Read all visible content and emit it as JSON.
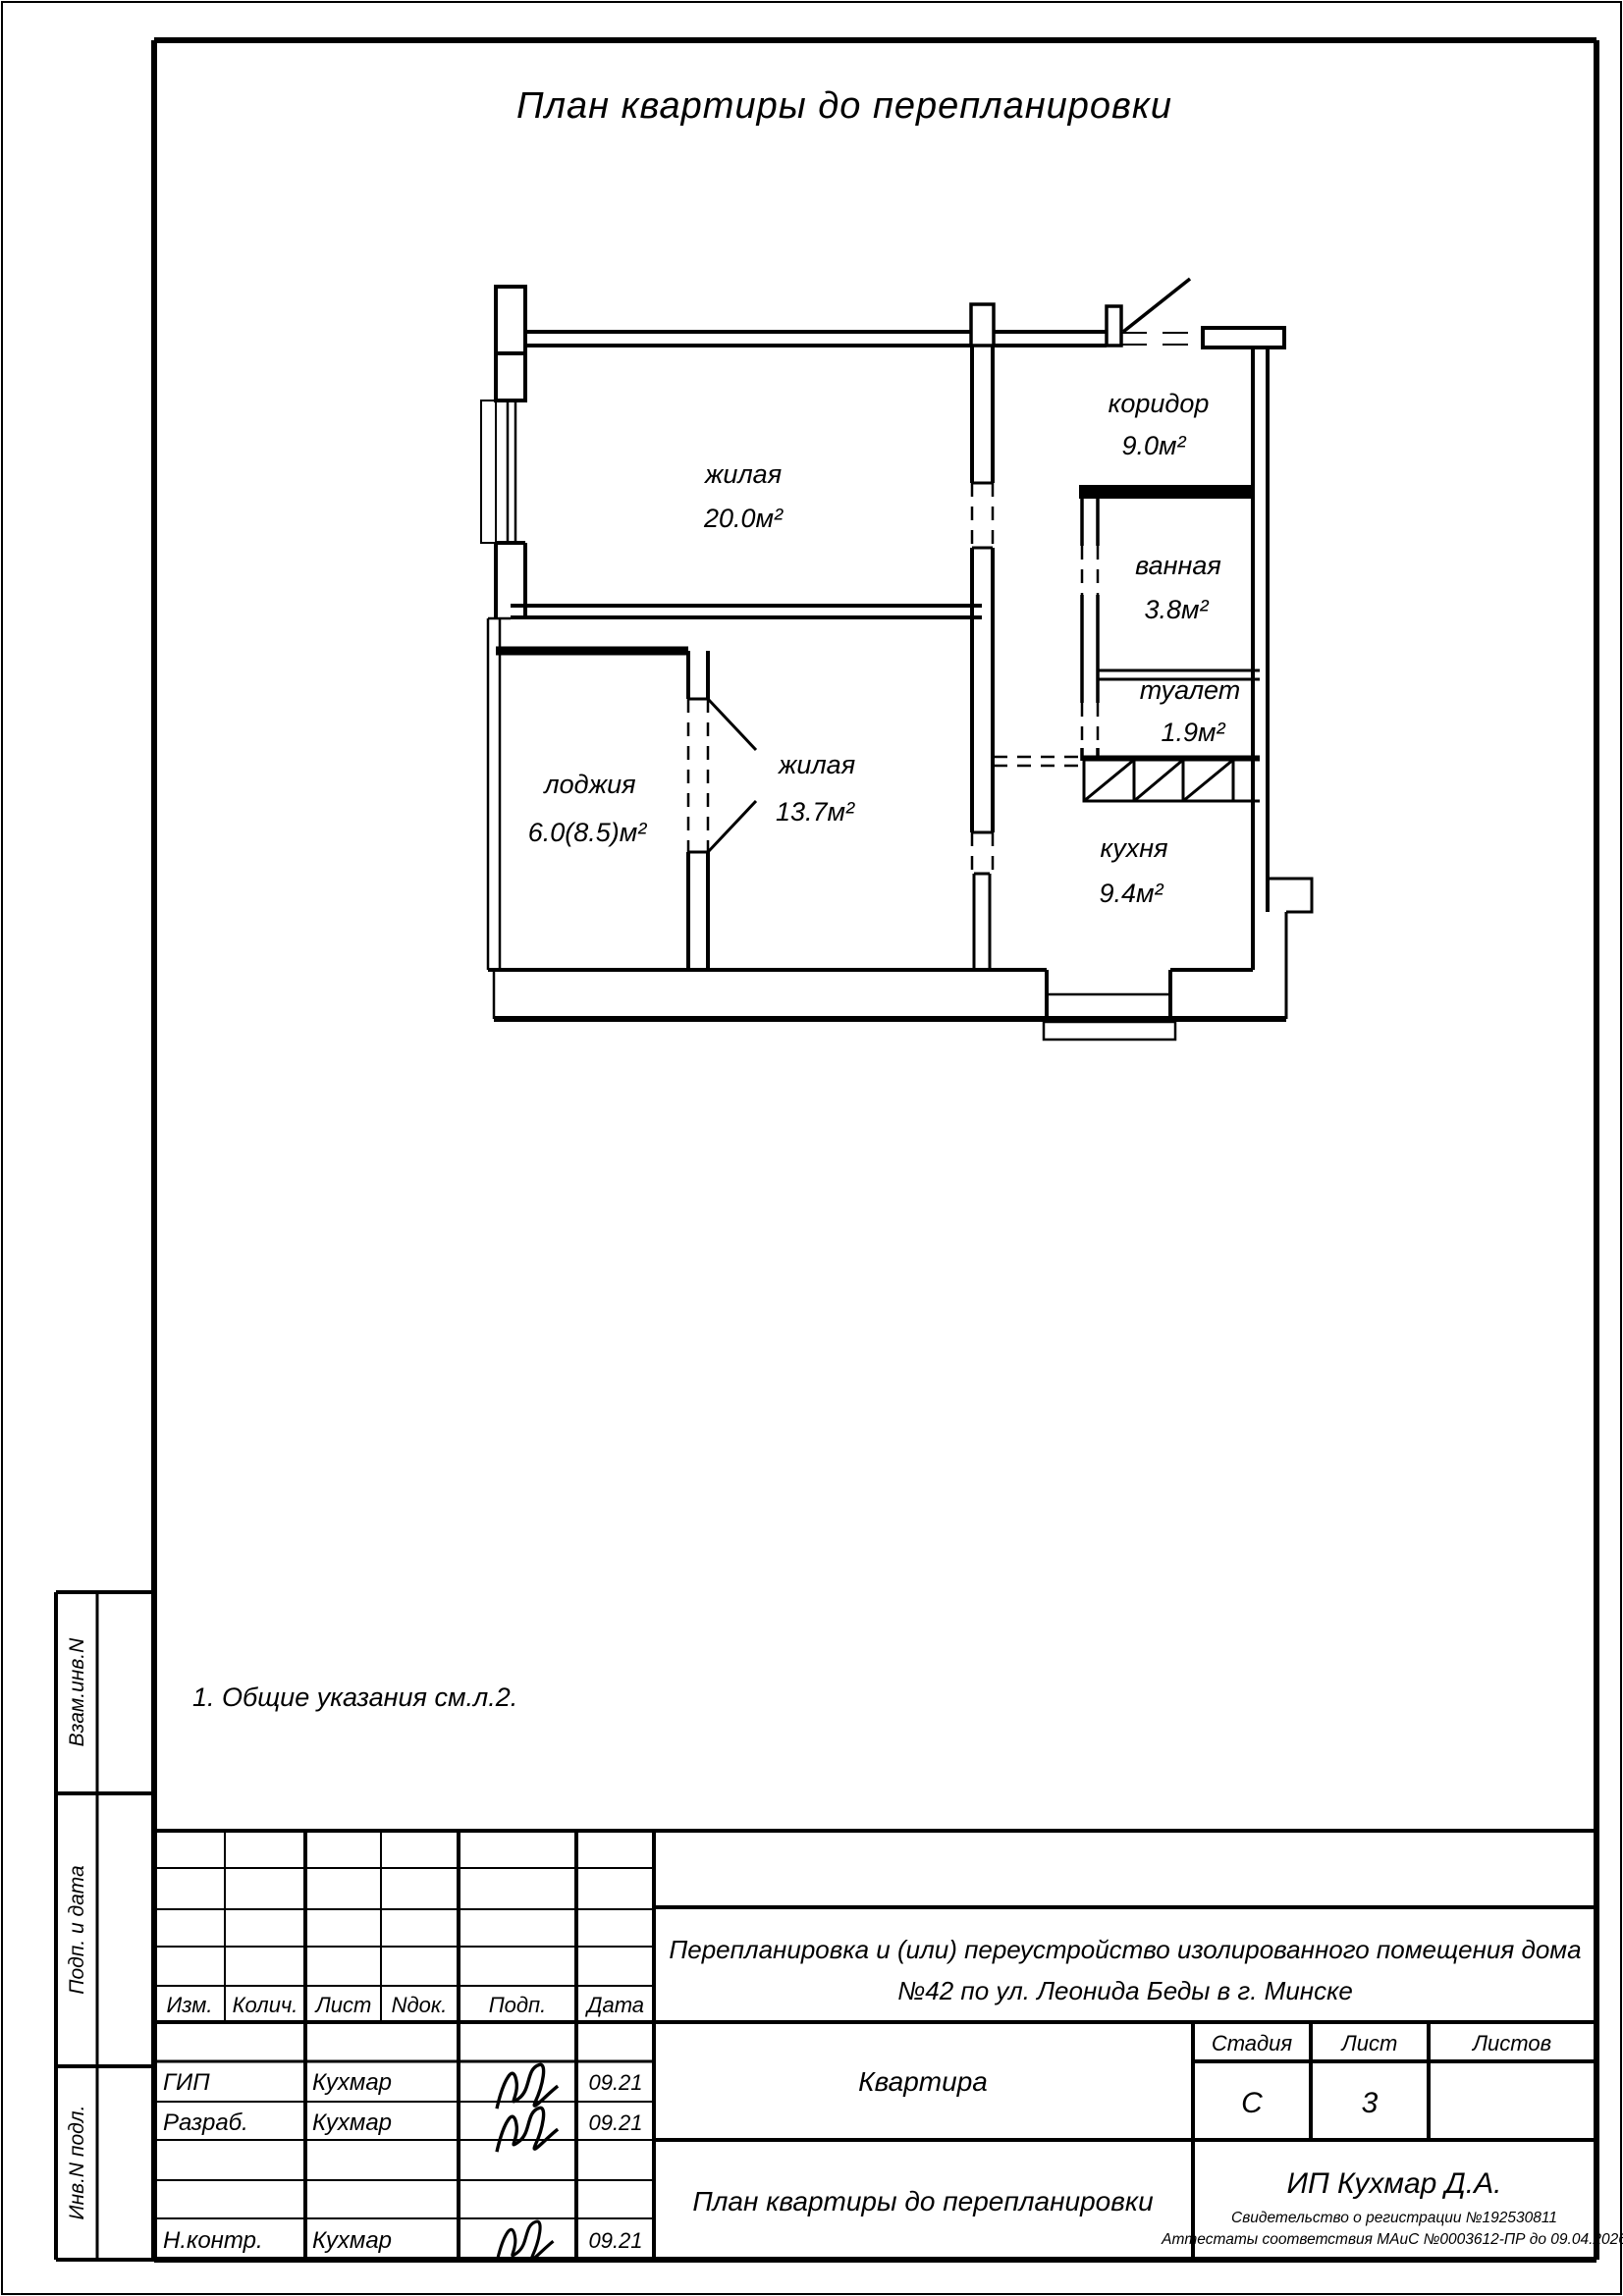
{
  "page": {
    "title": "План квартиры до перепланировки",
    "note": "1.  Общие указания см.л.2."
  },
  "plan": {
    "rooms": [
      {
        "name": "жилая",
        "area": "20.0м²"
      },
      {
        "name": "коридор",
        "area": "9.0м²"
      },
      {
        "name": "ванная",
        "area": "3.8м²"
      },
      {
        "name": "туалет",
        "area": "1.9м²"
      },
      {
        "name": "жилая",
        "area": "13.7м²"
      },
      {
        "name": "лоджия",
        "area": "6.0(8.5)м²"
      },
      {
        "name": "кухня",
        "area": "9.4м²"
      }
    ]
  },
  "side_labels": {
    "top": "Взам.инв.N",
    "middle": "Подп. и дата",
    "bottom": "Инв.N подл."
  },
  "stamp": {
    "header": {
      "izm": "Изм.",
      "kolich": "Колич.",
      "list": "Лист",
      "ndok": "Nдок.",
      "podp": "Подп.",
      "data": "Дата"
    },
    "rows": [
      {
        "role": "ГИП",
        "name": "Кухмар",
        "date": "09.21"
      },
      {
        "role": "Разраб.",
        "name": "Кухмар",
        "date": "09.21"
      },
      {
        "role": "Н.контр.",
        "name": "Кухмар",
        "date": "09.21"
      }
    ],
    "project": {
      "line1": "Перепланировка и (или) переустройство изолированного помещения дома",
      "line2": "№42  по ул. Леонида Беды в г. Минске"
    },
    "object": "Квартира",
    "sheet_title": "План квартиры до перепланировки",
    "stage_label": "Стадия",
    "sheet_label": "Лист",
    "sheets_label": "Листов",
    "stage": "С",
    "sheet_no": "3",
    "company": "ИП Кухмар Д.А.",
    "cert1": "Свидетельство о регистрации №192530811",
    "cert2": "Аттестаты соответствия МАиС №0003612-ПР до  09.04.2026"
  },
  "colors": {
    "ink": "#000000",
    "paper": "#ffffff"
  }
}
